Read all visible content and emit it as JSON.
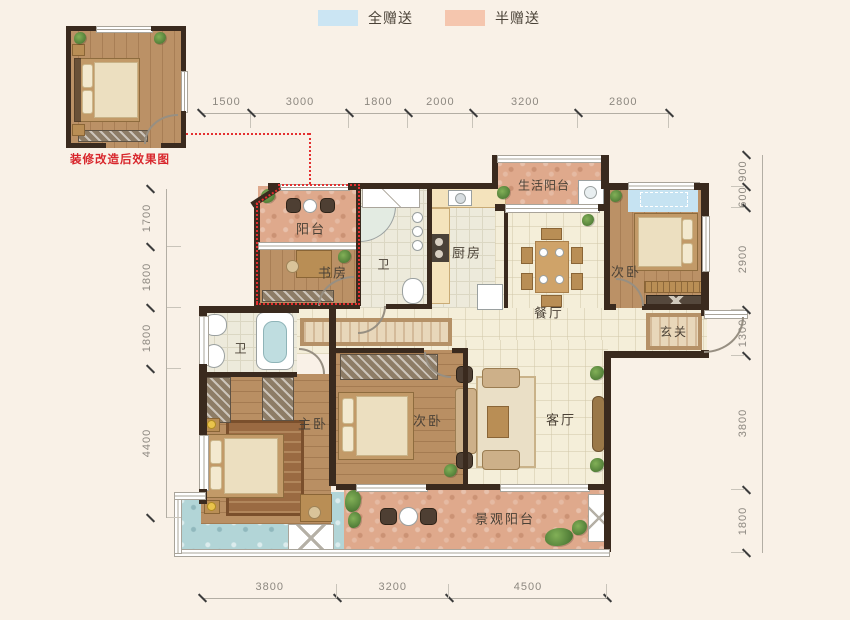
{
  "legend": {
    "items": [
      {
        "name": "full-gift",
        "label": "全赠送",
        "color": "#cbe5f3"
      },
      {
        "name": "half-gift",
        "label": "半赠送",
        "color": "#f5c6ae"
      }
    ]
  },
  "inset": {
    "caption": "装修改造后效果图"
  },
  "rooms": {
    "balcony": "阳台",
    "study": "书房",
    "bath_main": "卫",
    "kitchen": "厨房",
    "service_balcony": "生活阳台",
    "dining": "餐厅",
    "bedroom_top": "次卧",
    "foyer": "玄关",
    "master_bath": "卫",
    "master_bedroom": "主卧",
    "bedroom_mid": "次卧",
    "living": "客厅",
    "view_balcony": "景观阳台"
  },
  "dimensions": {
    "top": [
      "1500",
      "3000",
      "1800",
      "2000",
      "3200",
      "2800"
    ],
    "left": [
      "1700",
      "1800",
      "1800",
      "4400"
    ],
    "right": [
      "900",
      "600",
      "2900",
      "1300",
      "3800",
      "1800"
    ],
    "bottom": [
      "3800",
      "3200",
      "4500"
    ]
  },
  "colors": {
    "full_gift": "#cbe5f3",
    "half_gift": "#f5c6ae",
    "wall": "#3a2a1e",
    "gift_outline": "#e43030"
  }
}
